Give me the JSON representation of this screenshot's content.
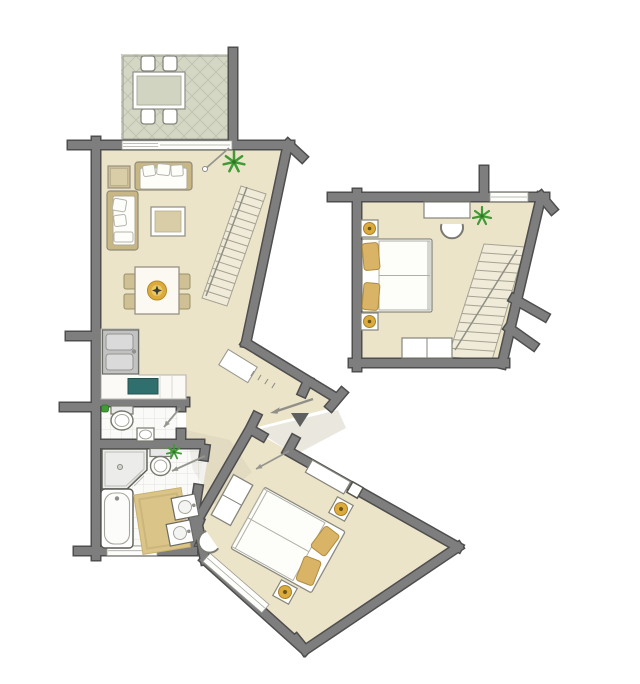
{
  "plan": {
    "type": "apartment-floor-plan",
    "orientation": "two-level-unit-with-detached-upper-room",
    "rooms": [
      {
        "name": "balcony",
        "floor_finish": "diamond-tile",
        "furniture": [
          "outdoor-dining-table",
          "outdoor-chair",
          "outdoor-chair",
          "outdoor-chair",
          "outdoor-chair"
        ]
      },
      {
        "name": "living-room",
        "floor_finish": "wood-beige",
        "furniture": [
          "sofa",
          "loveseat",
          "side-table",
          "coffee-table",
          "dining-table",
          "dining-chair",
          "dining-chair",
          "dining-chair",
          "dining-chair",
          "fruit-bowl",
          "staircase-up",
          "plant",
          "hall-cabinet"
        ]
      },
      {
        "name": "kitchen",
        "floor_finish": "wood-beige",
        "furniture": [
          "l-shaped-counter",
          "double-sink",
          "cooktop"
        ]
      },
      {
        "name": "wc",
        "floor_finish": "tile",
        "furniture": [
          "toilet",
          "hand-basin",
          "soap-plant"
        ]
      },
      {
        "name": "bathroom",
        "floor_finish": "tile",
        "furniture": [
          "shower",
          "toilet",
          "bathtub",
          "bath-mat",
          "vanity-sink",
          "vanity-sink",
          "plant"
        ]
      },
      {
        "name": "hallway",
        "floor_finish": "wood-beige",
        "furniture": [
          "entrance-threshold",
          "step-ticks"
        ]
      },
      {
        "name": "bedroom-lower",
        "floor_finish": "wood-beige",
        "furniture": [
          "double-bed",
          "pillow",
          "pillow",
          "nightstand-lamp",
          "nightstand-lamp",
          "wardrobe",
          "wall-shelf",
          "corner-unit",
          "chair",
          "window-band"
        ]
      },
      {
        "name": "bedroom-upper",
        "floor_finish": "wood-beige",
        "furniture": [
          "double-bed",
          "pillow",
          "pillow",
          "nightstand-lamp",
          "nightstand-lamp",
          "desk",
          "chair",
          "dresser",
          "staircase-down",
          "plant",
          "window-band"
        ]
      }
    ],
    "markers": {
      "entrance_triangle": true,
      "entrance_arrow": true,
      "door_swing_lines": 4
    }
  },
  "stairs": {
    "living_room": {
      "steps": 15
    },
    "bedroom_upper": {
      "steps": 13
    }
  },
  "colors": {
    "floor": "#ece4c9",
    "wall_fill": "#7e7e7e",
    "wall_outline": "#4e4e4e",
    "balcony_floor": "#d5d7c5",
    "lattice": "#c0c3b2",
    "tile_bg": "#fafaf8",
    "tile_line": "#e3e3de",
    "wood": "#c9b685",
    "gold": "#dcab3c",
    "pillow": "#d9b467",
    "plant": "#3f9b35",
    "stove": "#2f6f6e",
    "stair_fill": "#f0ead8",
    "stair_line": "#a5a292",
    "door_line": "#969690",
    "window_fill": "#fdfdfb",
    "mat": "#dbc487",
    "shade": "#e6e3d9",
    "entrance_marker": "#5f5f5f"
  }
}
